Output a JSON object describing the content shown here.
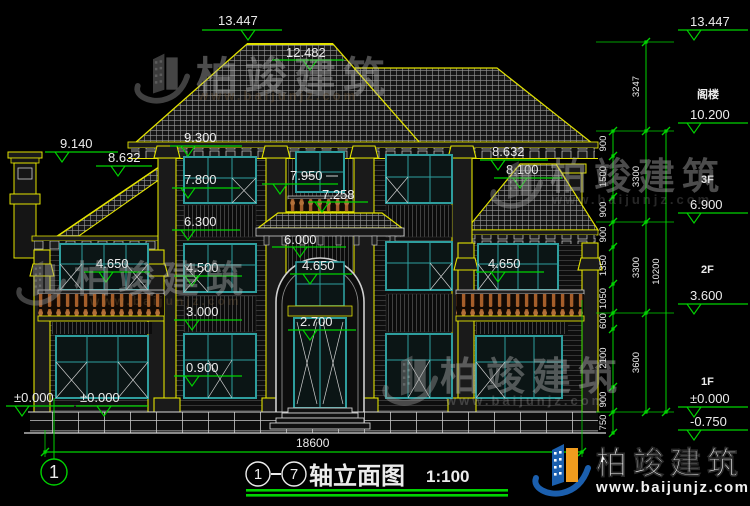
{
  "drawing": {
    "title": "轴立面图",
    "axis_from": "1",
    "axis_to": "7",
    "scale": "1:100",
    "bottom_dimension": "18600",
    "axis_bubble": "1"
  },
  "levels": [
    {
      "id": "peak",
      "label": "13.447"
    },
    {
      "id": "rear-ridge",
      "label": "12.482"
    },
    {
      "id": "chimney",
      "label": "9.140"
    },
    {
      "id": "left-eave",
      "label": "8.632"
    },
    {
      "id": "main-eave",
      "label": "9.300"
    },
    {
      "id": "f3-window",
      "label": "7.800"
    },
    {
      "id": "f3-center",
      "label": "7.950"
    },
    {
      "id": "f3-rail",
      "label": "7.258"
    },
    {
      "id": "mid-cornice",
      "label": "6.300"
    },
    {
      "id": "canopy",
      "label": "6.000"
    },
    {
      "id": "right-eave",
      "label": "8.632"
    },
    {
      "id": "right-ridge",
      "label": "8.100"
    },
    {
      "id": "lw-window",
      "label": "4.650"
    },
    {
      "id": "f2-window",
      "label": "4.500"
    },
    {
      "id": "arch-window",
      "label": "4.650"
    },
    {
      "id": "rw-window",
      "label": "4.650"
    },
    {
      "id": "f2-rail",
      "label": "3.000"
    },
    {
      "id": "door-head",
      "label": "2.700"
    },
    {
      "id": "f1-sill",
      "label": "0.900"
    },
    {
      "id": "ground-a",
      "label": "±0.000"
    },
    {
      "id": "ground-b",
      "label": "±0.000"
    }
  ],
  "right_levels": [
    {
      "id": "r-peak",
      "label": "13.447"
    },
    {
      "id": "r-attic",
      "label": "10.200"
    },
    {
      "id": "r-3f",
      "label": "6.900"
    },
    {
      "id": "r-2f",
      "label": "3.600"
    },
    {
      "id": "r-1f",
      "label": "±0.000"
    },
    {
      "id": "r-base",
      "label": "-0.750"
    }
  ],
  "floor_labels": [
    {
      "id": "attic",
      "label": "阁楼"
    },
    {
      "id": "3f",
      "label": "3F"
    },
    {
      "id": "2f",
      "label": "2F"
    },
    {
      "id": "1f",
      "label": "1F"
    }
  ],
  "dim_chains": {
    "inner": {
      "values": [
        "900",
        "1500",
        "900",
        "900",
        "1350",
        "1050",
        "600",
        "2100",
        "900",
        "750"
      ]
    },
    "middle": {
      "values": [
        "3247",
        "3300",
        "3300",
        "3600"
      ]
    },
    "outer": {
      "values": [
        "10200"
      ]
    }
  },
  "watermark": {
    "name": "柏竣建筑",
    "url": "www.baijunjz.com"
  },
  "logo": {
    "name": "柏竣建筑",
    "url": "www.baijunjz.com"
  },
  "colors": {
    "dimension_green": "#00d400",
    "trim_yellow": "#e2e200",
    "window_teal": "#2e9e9e",
    "label_white": "#ececec",
    "baluster_brown": "#a55e2a",
    "logo_blue": "#1b5fae",
    "logo_orange": "#f09c1e"
  }
}
